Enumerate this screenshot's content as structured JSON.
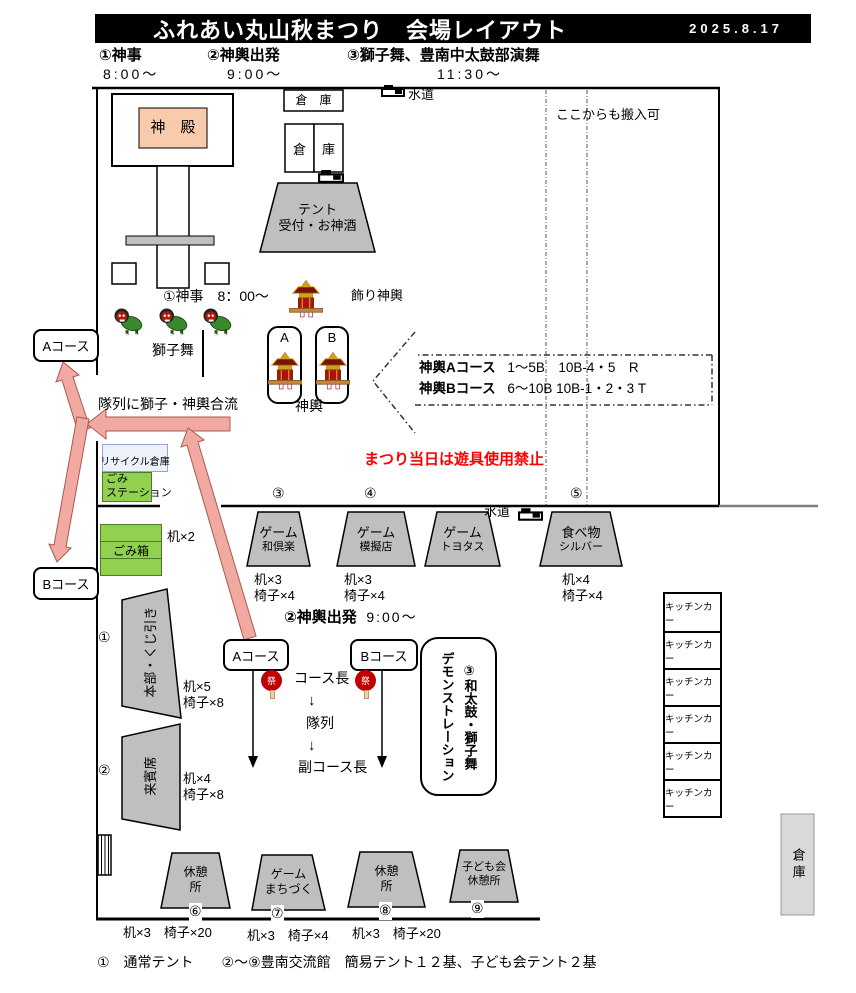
{
  "colors": {
    "header_bg": "#000000",
    "header_text": "#ffffff",
    "shrine_fill": "#f8cbad",
    "tent_fill": "#bfbfbf",
    "green": "#92d050",
    "arrow_pink": "#f2a9a2",
    "warning_red": "#ff0000",
    "lantern_red": "#c00000",
    "recycle_border": "#8fa8d8"
  },
  "icons": {
    "faucet": "faucet-icon",
    "mikoshi": "mikoshi-icon",
    "lion": "lion-dance-icon",
    "fan": "festival-fan-icon"
  },
  "header": {
    "title": "ふれあい丸山秋まつり　会場レイアウト",
    "date": "2025.8.17"
  },
  "schedule": [
    {
      "label": "①神事",
      "time": "8:00～"
    },
    {
      "label": "②神輿出発",
      "time": "9:00～"
    },
    {
      "label": "③獅子舞、豊南中太鼓部演舞",
      "time": "11:30～"
    }
  ],
  "map": {
    "shrine": "神　殿",
    "warehouse_top": "倉　庫",
    "warehouse_mid_l": "倉",
    "warehouse_mid_r": "庫",
    "water_top": "水道",
    "water_mid": "水道",
    "tent_reception_1": "テント",
    "tent_reception_2": "受付・お神酒",
    "carry_in": "ここからも搬入可",
    "shinji": "①神事　8：00～",
    "deco_mikoshi": "飾り神輿",
    "lion_dance": "獅子舞",
    "slot_a": "A",
    "slot_b": "B",
    "mikoshi": "神輿",
    "course_a": "Aコース",
    "course_b": "Bコース",
    "merge": "隊列に獅子・神輿合流",
    "route_a_name": "神輿Aコース",
    "route_a_detail": "1～5B　10B-4・5　R",
    "route_b_name": "神輿Bコース",
    "route_b_detail": "6～10B 10B-1・2・3 T",
    "warning": "まつり当日は遊具使用禁止",
    "recycle": "リサイクル倉庫",
    "trash_station_1": "ごみ",
    "trash_station_2": "ステーション",
    "trash_cans": "ごみ箱",
    "desks_2": "机×2"
  },
  "booths": [
    {
      "num": "③",
      "line1": "ゲーム",
      "line2": "和倶楽",
      "desks": "机×3",
      "chairs": "椅子×4"
    },
    {
      "num": "④",
      "line1": "ゲーム",
      "line2": "模擬店",
      "desks": "机×3",
      "chairs": "椅子×4"
    },
    {
      "num": "",
      "line1": "ゲーム",
      "line2": "トヨタス",
      "desks": "",
      "chairs": ""
    },
    {
      "num": "⑤",
      "line1": "食べ物",
      "line2": "シルバー",
      "desks": "机×4",
      "chairs": "椅子×4"
    }
  ],
  "departure": {
    "label": "②神輿出発",
    "time": "9:00～",
    "course_a": "Aコース",
    "course_b": "Bコース",
    "fan": "祭",
    "leader": "コース長",
    "arrow1": "↓",
    "column": "隊列",
    "arrow2": "↓",
    "sub_leader": "副コース長"
  },
  "demo_box": {
    "line1": "③和太鼓・獅子舞",
    "line2": "デモンストレーション"
  },
  "left_tents": [
    {
      "num": "①",
      "name": "本部・くじ引き",
      "desks": "机×5",
      "chairs": "椅子×8"
    },
    {
      "num": "②",
      "name": "来賓席",
      "desks": "机×4",
      "chairs": "椅子×8"
    }
  ],
  "bottom_tents": [
    {
      "num": "⑥",
      "line1": "休憩",
      "line2": "所",
      "note": "机×3　椅子×20"
    },
    {
      "num": "⑦",
      "line1": "ゲーム",
      "line2": "まちづく",
      "note": "机×3　椅子×4"
    },
    {
      "num": "⑧",
      "line1": "休憩",
      "line2": "所",
      "note": "机×3　椅子×20"
    },
    {
      "num": "⑨",
      "line1": "子ども会",
      "line2": "休憩所",
      "note": ""
    }
  ],
  "kitchen_car": "キッチンカー",
  "warehouse_right": "倉庫",
  "footnote": "①　通常テント　　②～⑨豊南交流館　簡易テント１２基、子ども会テント２基"
}
